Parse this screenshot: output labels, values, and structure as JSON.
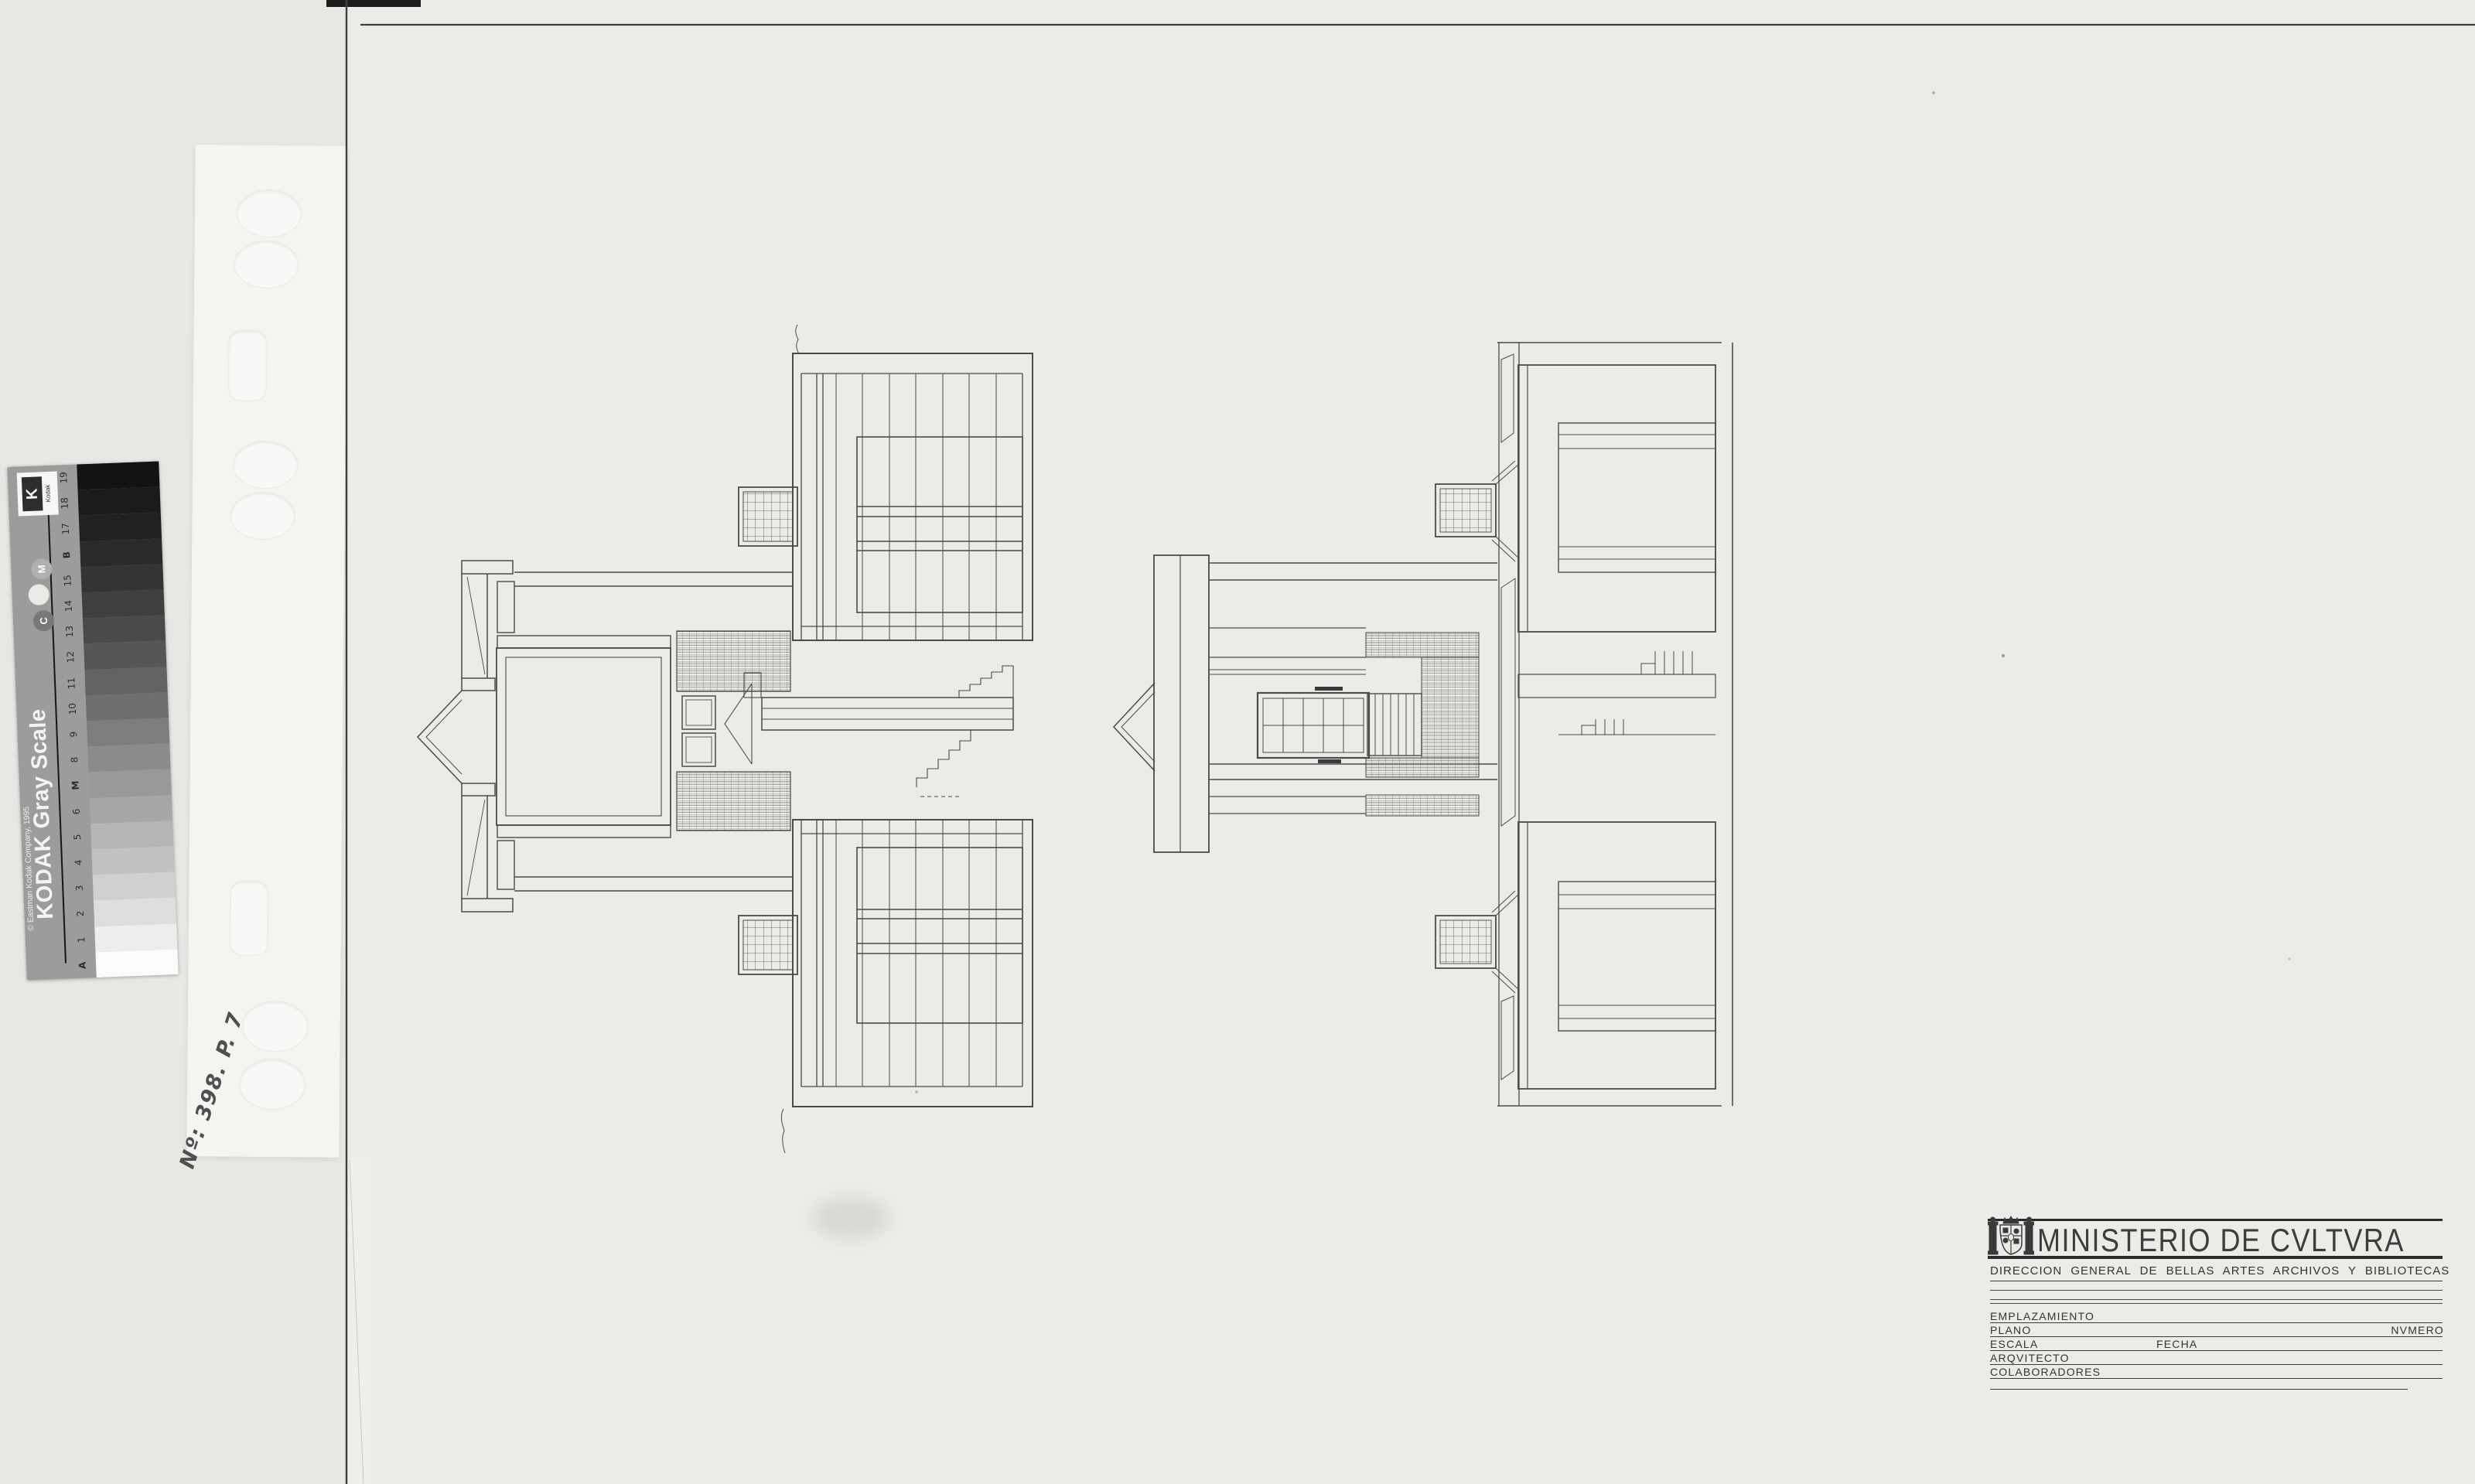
{
  "kodak_bar": {
    "title": "KODAK Gray Scale",
    "copyright": "© Eastman Kodak Company, 1995",
    "logo_text": "Kodak",
    "logo_letter": "K",
    "steps": [
      {
        "label": "19",
        "hex": "#131313"
      },
      {
        "label": "18",
        "hex": "#1a1a1a"
      },
      {
        "label": "17",
        "hex": "#212121"
      },
      {
        "label": "B",
        "hex": "#2a2a2a",
        "bold": true
      },
      {
        "label": "15",
        "hex": "#343434"
      },
      {
        "label": "14",
        "hex": "#3f3f3f"
      },
      {
        "label": "13",
        "hex": "#4a4a4a"
      },
      {
        "label": "12",
        "hex": "#565656"
      },
      {
        "label": "11",
        "hex": "#626262"
      },
      {
        "label": "10",
        "hex": "#6f6f6f"
      },
      {
        "label": "9",
        "hex": "#7d7d7d"
      },
      {
        "label": "8",
        "hex": "#8b8b8b"
      },
      {
        "label": "M",
        "hex": "#999999",
        "bold": true
      },
      {
        "label": "6",
        "hex": "#a7a7a7"
      },
      {
        "label": "5",
        "hex": "#b5b5b5"
      },
      {
        "label": "4",
        "hex": "#c2c2c2"
      },
      {
        "label": "3",
        "hex": "#d0d0d0"
      },
      {
        "label": "2",
        "hex": "#dedede"
      },
      {
        "label": "1",
        "hex": "#ededed"
      },
      {
        "label": "A",
        "hex": "#fbfbfb",
        "bold": true
      }
    ],
    "circles": [
      {
        "label": "M",
        "hex": "#b0b0b0"
      },
      {
        "label": "",
        "hex": "#e9e9e5"
      },
      {
        "label": "C",
        "hex": "#787878"
      }
    ]
  },
  "annotations": {
    "handwritten_number": "Nº: 398. P. 7"
  },
  "title_block": {
    "ministry": "MINISTERIO DE CVLTVRA",
    "department": "DIRECCION GENERAL DE BELLAS ARTES ARCHIVOS Y BIBLIOTECAS",
    "fields": {
      "emplazamiento": "EMPLAZAMIENTO",
      "plano": "PLANO",
      "numero": "NVMERO",
      "escala": "ESCALA",
      "fecha": "FECHA",
      "arquitecto": "ARQVITECTO",
      "colaboradores": "COLABORADORES"
    }
  },
  "colors": {
    "paper": "#ebebe8",
    "scan_background": "#e6e6e3",
    "sleeve": "#f4f4f1",
    "ink": "#4a4a4a",
    "bar_body": "#9c9c9c"
  }
}
